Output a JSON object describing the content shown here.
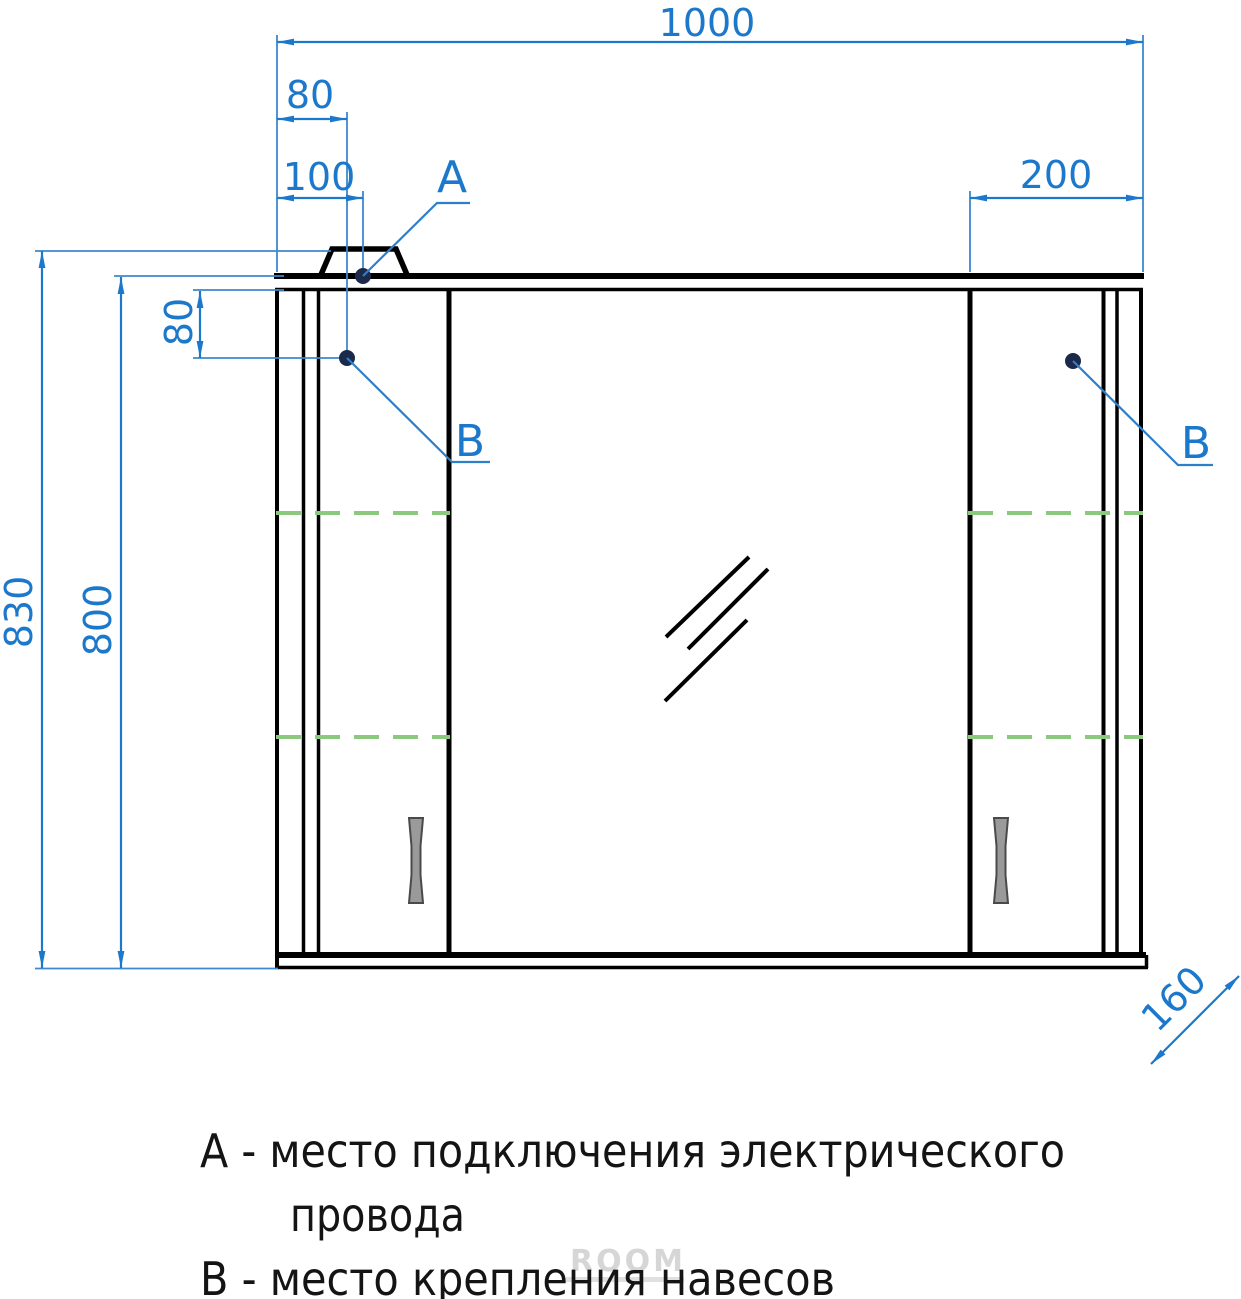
{
  "dimensions": {
    "total_width": "1000",
    "b_offset_left": "80",
    "a_offset_left": "100",
    "right_door_width": "200",
    "overall_height": "830",
    "cabinet_height": "800",
    "b_offset_top": "80",
    "depth": "160"
  },
  "markers": {
    "point_a": "А",
    "point_b_left": "В",
    "point_b_right": "В"
  },
  "legend": {
    "line_a1": "А - место подключения электрического",
    "line_a2": "провода",
    "line_b": "В - место крепления навесов"
  },
  "watermark": {
    "text": "ROOM"
  },
  "colors": {
    "dimension_blue": "#1c78cb",
    "object_black": "#000000",
    "shelf_green": "#8bc97e",
    "handle_gray": "#9a9a9a"
  }
}
